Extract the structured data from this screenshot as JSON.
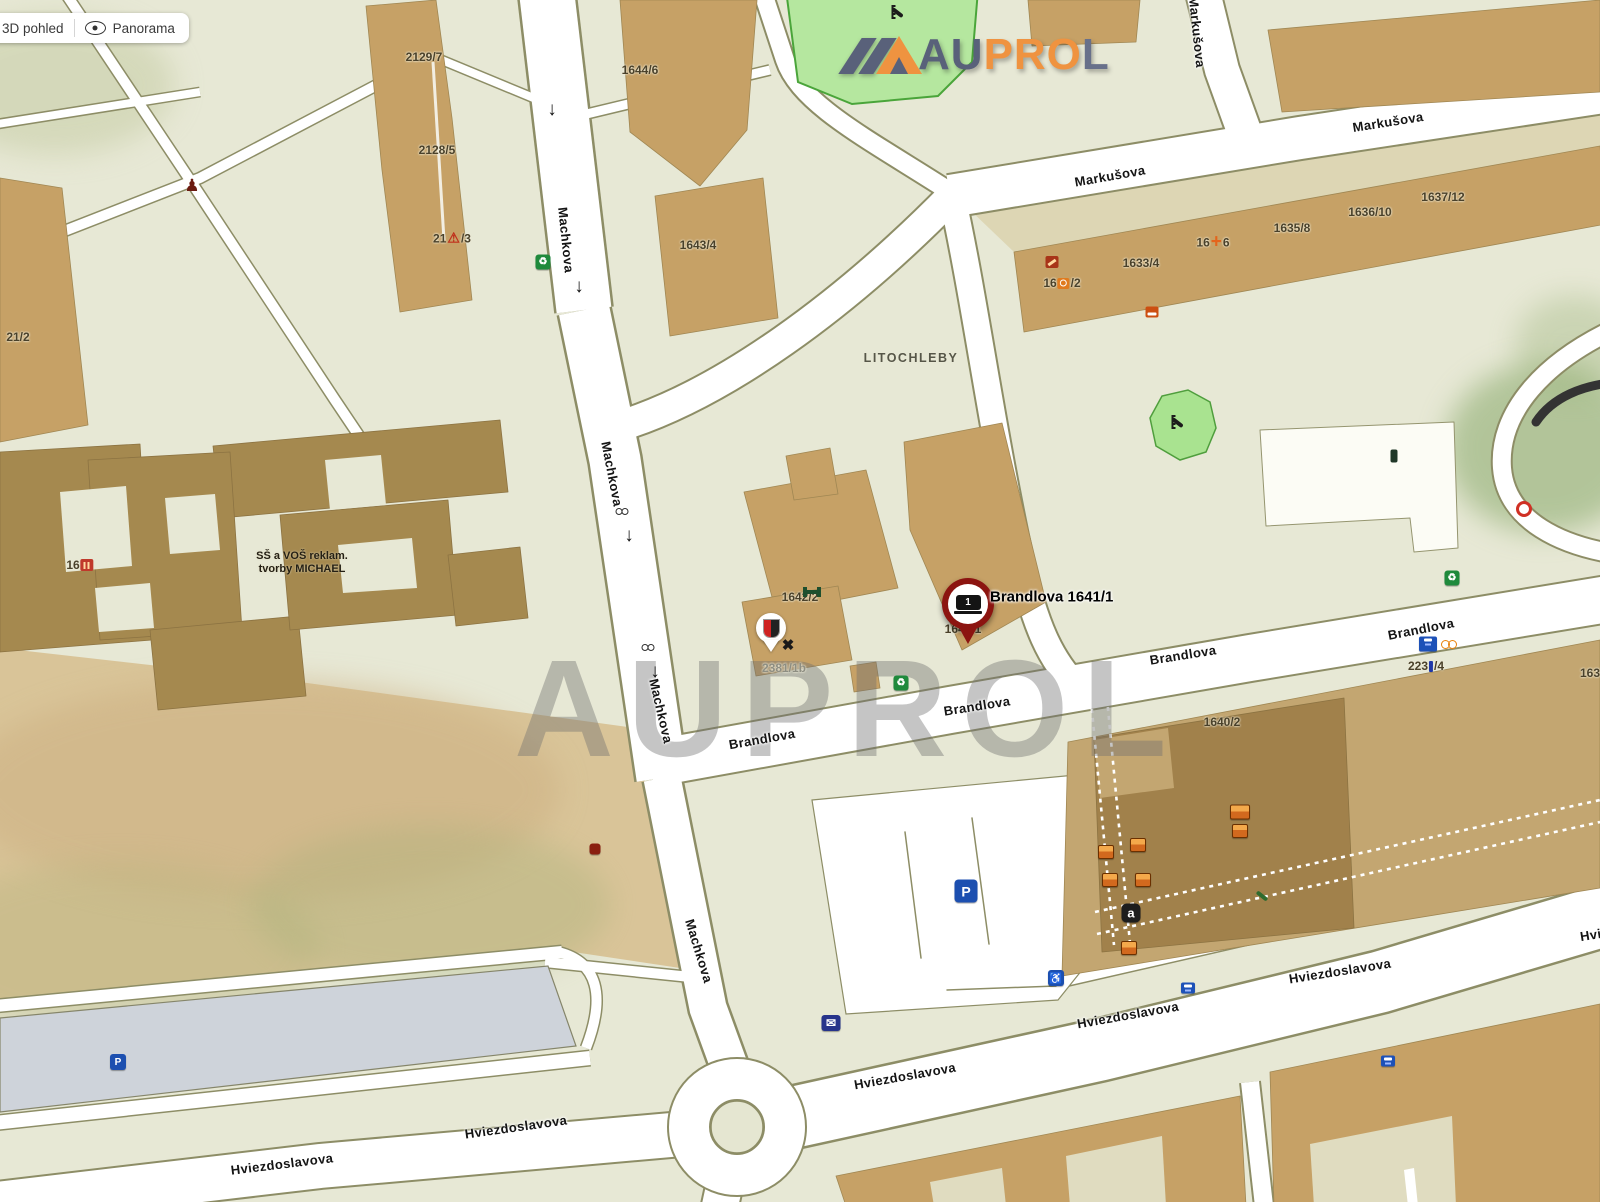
{
  "toolbar": {
    "view_3d_label": "3D pohled",
    "panorama_label": "Panorama"
  },
  "logo": {
    "au": "AU",
    "pro": "PRO",
    "l": "L"
  },
  "watermark_text": "AUPROL",
  "marker": {
    "label": "Brandlova 1641/1",
    "number": "1"
  },
  "map": {
    "district": "LITOCHLEBY",
    "school": {
      "line1": "SŠ a VOŠ reklam.",
      "line2": "tvorby MICHAEL",
      "number": "16"
    },
    "streets": {
      "machkova": "Machkova",
      "markusova": "Markušova",
      "brandlova": "Brandlova",
      "hviezdoslavova": "Hviezdoslavova",
      "hviezdoslavova_cut": "Hvi"
    },
    "buildings": {
      "b2129_7": "2129/7",
      "b2128_5": "2128/5",
      "b2127_3a": "21",
      "b2127_3b": "/3",
      "b2121_2": "21/2",
      "b1644_6": "1644/6",
      "b1643_4": "1643/4",
      "b1642_2": "1642/2",
      "b1641_1": "1641/1",
      "b2381_1b": "2381/1b",
      "b1640_2": "1640/2",
      "b2237_4a": "223",
      "b2237_4b": "/4",
      "b163_cut": "163",
      "b1633_4": "1633/4",
      "b1634_6a": "16",
      "b1634_6b": "6",
      "b1635_8": "1635/8",
      "b1636_10": "1636/10",
      "b1637_12": "1637/12",
      "b1632_2a": "16",
      "b1632_2b": "/2"
    },
    "icons": {
      "arrow_down": "↓",
      "recycle": "♻",
      "warning": "⚠",
      "monument": "♟",
      "restaurant": "✖",
      "envelope": "✉",
      "wheelchair": "♿",
      "parking": "P",
      "alza": "a",
      "pharmacy_cross": "+"
    }
  }
}
